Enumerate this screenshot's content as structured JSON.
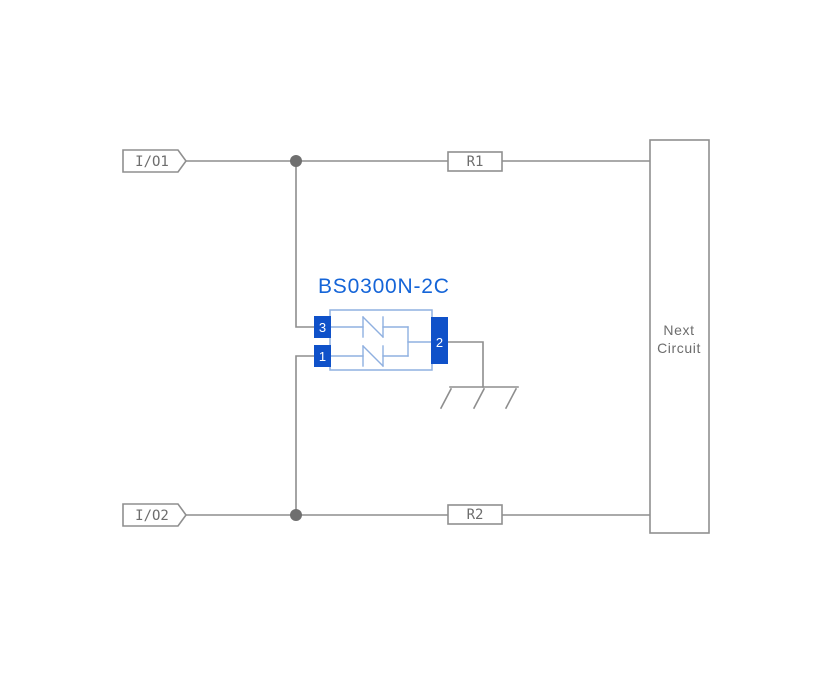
{
  "diagram": {
    "component": {
      "part_number": "BS0300N-2C",
      "pin_top_left": "3",
      "pin_bottom_left": "1",
      "pin_right": "2"
    },
    "connectors": {
      "io1": "I/O1",
      "io2": "I/O2"
    },
    "resistors": {
      "r1": "R1",
      "r2": "R2"
    },
    "next_circuit": {
      "line1": "Next",
      "line2": "Circuit"
    }
  },
  "colors": {
    "background": "#ffffff",
    "wire": "#8e8e8e",
    "junction-dot": "#6f6f6f",
    "box-stroke": "#8f8f8f",
    "component-stroke": "#8fb0e0",
    "pin-fill": "#0f51c9",
    "pin-text": "#ffffff",
    "part-number-blue": "#1565d8",
    "label-text": "#6d6d6d"
  }
}
